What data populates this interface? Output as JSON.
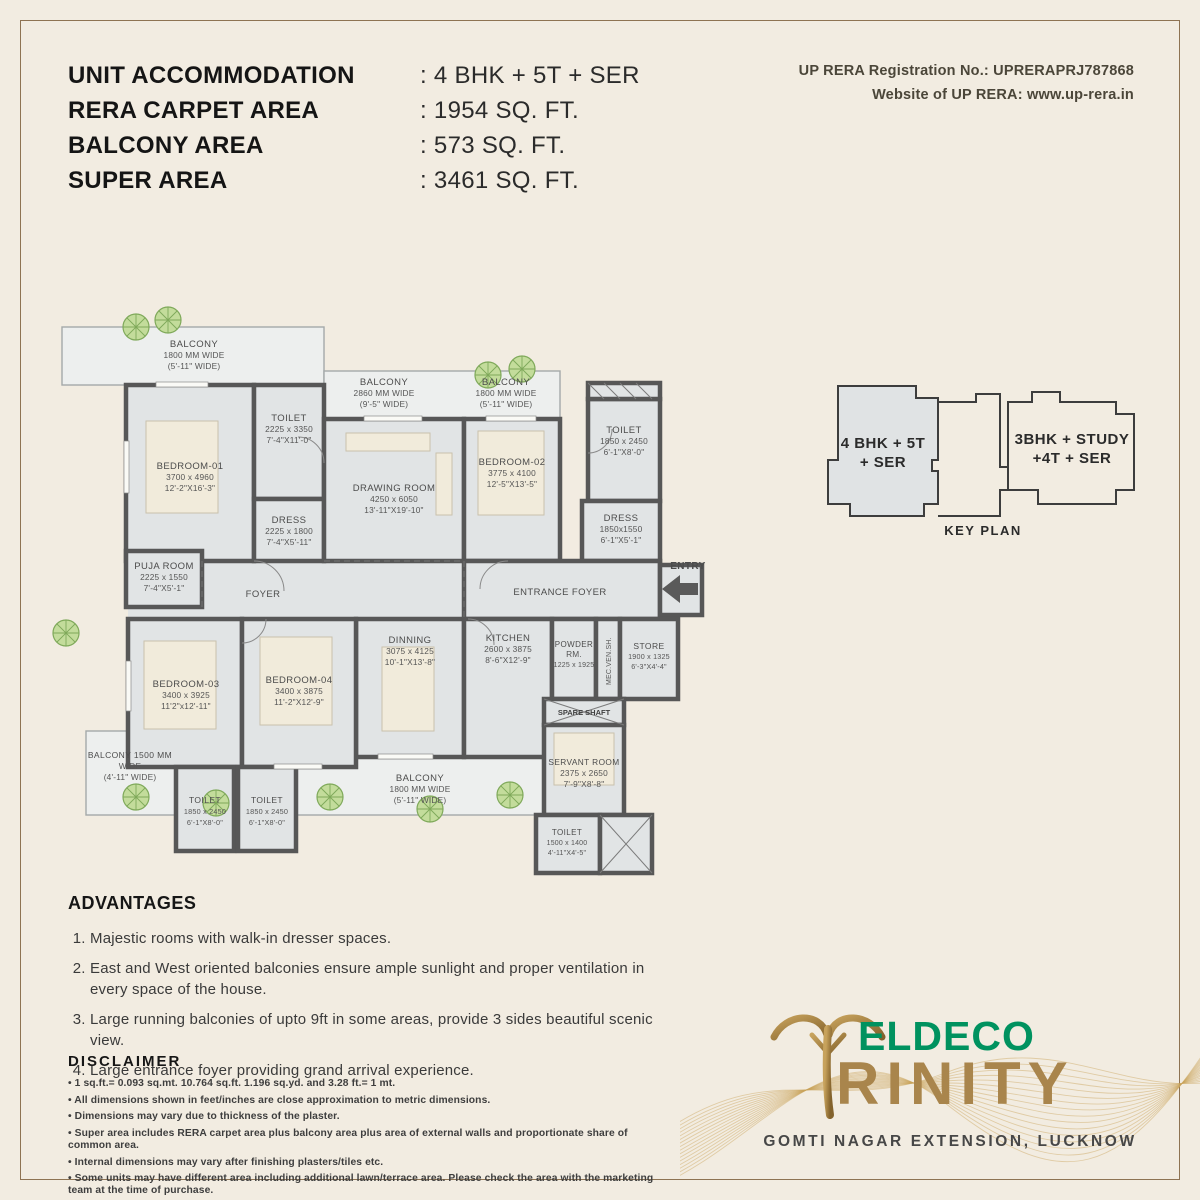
{
  "colors": {
    "page_bg": "#f2ece1",
    "frame_border": "#8e7352",
    "wall": "#575757",
    "room_fill": "#e1e4e5",
    "accent_green": "#00925f",
    "gold": "#a9854c"
  },
  "header": {
    "specs": [
      {
        "label": "UNIT ACCOMMODATION",
        "value": ": 4 BHK + 5T + SER"
      },
      {
        "label": "RERA CARPET AREA",
        "value": ": 1954 SQ. FT."
      },
      {
        "label": "BALCONY AREA",
        "value": ": 573 SQ. FT."
      },
      {
        "label": "SUPER AREA",
        "value": ": 3461 SQ. FT."
      }
    ],
    "rera_line1": "UP RERA Registration No.: UPRERAPRJ787868",
    "rera_line2": "Website of UP RERA: www.up-rera.in"
  },
  "plan": {
    "rooms": [
      {
        "name": "BALCONY",
        "l2": "1800 MM WIDE",
        "l3": "(5'-11\" WIDE)"
      },
      {
        "name": "BALCONY",
        "l2": "2860 MM WIDE",
        "l3": "(9'-5\" WIDE)"
      },
      {
        "name": "BALCONY",
        "l2": "1800 MM WIDE",
        "l3": "(5'-11\" WIDE)"
      },
      {
        "name": "TOILET",
        "l2": "2225 x 3350",
        "l3": "7'-4\"X11'-0\""
      },
      {
        "name": "BEDROOM-01",
        "l2": "3700 x 4960",
        "l3": "12'-2\"X16'-3\""
      },
      {
        "name": "DRESS",
        "l2": "2225 x 1800",
        "l3": "7'-4\"X5'-11\""
      },
      {
        "name": "DRAWING ROOM",
        "l2": "4250 x 6050",
        "l3": "13'-11\"X19'-10\""
      },
      {
        "name": "BEDROOM-02",
        "l2": "3775 x 4100",
        "l3": "12'-5\"X13'-5\""
      },
      {
        "name": "TOILET",
        "l2": "1850 x 2450",
        "l3": "6'-1\"X8'-0\""
      },
      {
        "name": "DRESS",
        "l2": "1850x1550",
        "l3": "6'-1\"X5'-1\""
      },
      {
        "name": "PUJA ROOM",
        "l2": "2225 x 1550",
        "l3": "7'-4\"X5'-1\""
      },
      {
        "name": "FOYER",
        "l2": "",
        "l3": ""
      },
      {
        "name": "ENTRANCE FOYER",
        "l2": "",
        "l3": ""
      },
      {
        "name": "DINNING",
        "l2": "3075 x 4125",
        "l3": "10'-1\"X13'-8\""
      },
      {
        "name": "KITCHEN",
        "l2": "2600 x 3875",
        "l3": "8'-6\"X12'-9\""
      },
      {
        "name": "POWDER",
        "l2": "RM.",
        "l3": "1225 x 1925"
      },
      {
        "name": "MEC.VEN.SH.",
        "l2": "",
        "l3": ""
      },
      {
        "name": "STORE",
        "l2": "1900 x 1325",
        "l3": "6'-3\"X4'-4\""
      },
      {
        "name": "SPARE SHAFT",
        "l2": "",
        "l3": ""
      },
      {
        "name": "BEDROOM-03",
        "l2": "3400 x 3925",
        "l3": "11'2\"x12'-11\""
      },
      {
        "name": "BEDROOM-04",
        "l2": "3400 x 3875",
        "l3": "11'-2\"X12'-9\""
      },
      {
        "name": "BALCONY 1500 MM",
        "l2": "WIDE",
        "l3": "(4'-11\" WIDE)"
      },
      {
        "name": "TOILET",
        "l2": "1850 x 2450",
        "l3": "6'-1\"X8'-0\""
      },
      {
        "name": "TOILET",
        "l2": "1850 x 2450",
        "l3": "6'-1\"X8'-0\""
      },
      {
        "name": "BALCONY",
        "l2": "1800 MM WIDE",
        "l3": "(5'-11\" WIDE)"
      },
      {
        "name": "SERVANT ROOM",
        "l2": "2375 x 2650",
        "l3": "7'-9\"X8'-8\""
      },
      {
        "name": "TOILET",
        "l2": "1500 x 1400",
        "l3": "4'-11\"X4'-5\""
      },
      {
        "name": "ENTRY",
        "l2": "",
        "l3": ""
      }
    ]
  },
  "key_plan": {
    "left_line1": "4 BHK + 5T",
    "left_line2": "+ SER",
    "right_line1": "3BHK + STUDY",
    "right_line2": "+4T + SER",
    "caption": "KEY PLAN"
  },
  "advantages": {
    "title": "ADVANTAGES",
    "items": [
      "Majestic rooms with walk-in dresser spaces.",
      "East and West oriented balconies ensure ample sunlight and proper ventilation in every space of the house.",
      "Large running balconies of upto 9ft in some areas, provide 3 sides beautiful scenic view.",
      "Large entrance foyer providing grand arrival experience."
    ]
  },
  "disclaimer": {
    "title": "DISCLAIMER",
    "items": [
      "1 sq.ft.= 0.093 sq.mt. 10.764 sq.ft. 1.196 sq.yd. and 3.28 ft.= 1 mt.",
      "All dimensions shown in feet/inches are close approximation to metric dimensions.",
      "Dimensions may vary due to thickness of the plaster.",
      "Super area includes RERA carpet area plus balcony area plus area of external walls and proportionate share of common area.",
      "Internal dimensions may vary after finishing plasters/tiles etc.",
      "Some units may have different area including additional lawn/terrace area. Please check the area with the marketing team at the time of purchase."
    ]
  },
  "logo": {
    "brand": "ELDECO",
    "project": "RINITY",
    "location": "GOMTI NAGAR EXTENSION, LUCKNOW"
  }
}
